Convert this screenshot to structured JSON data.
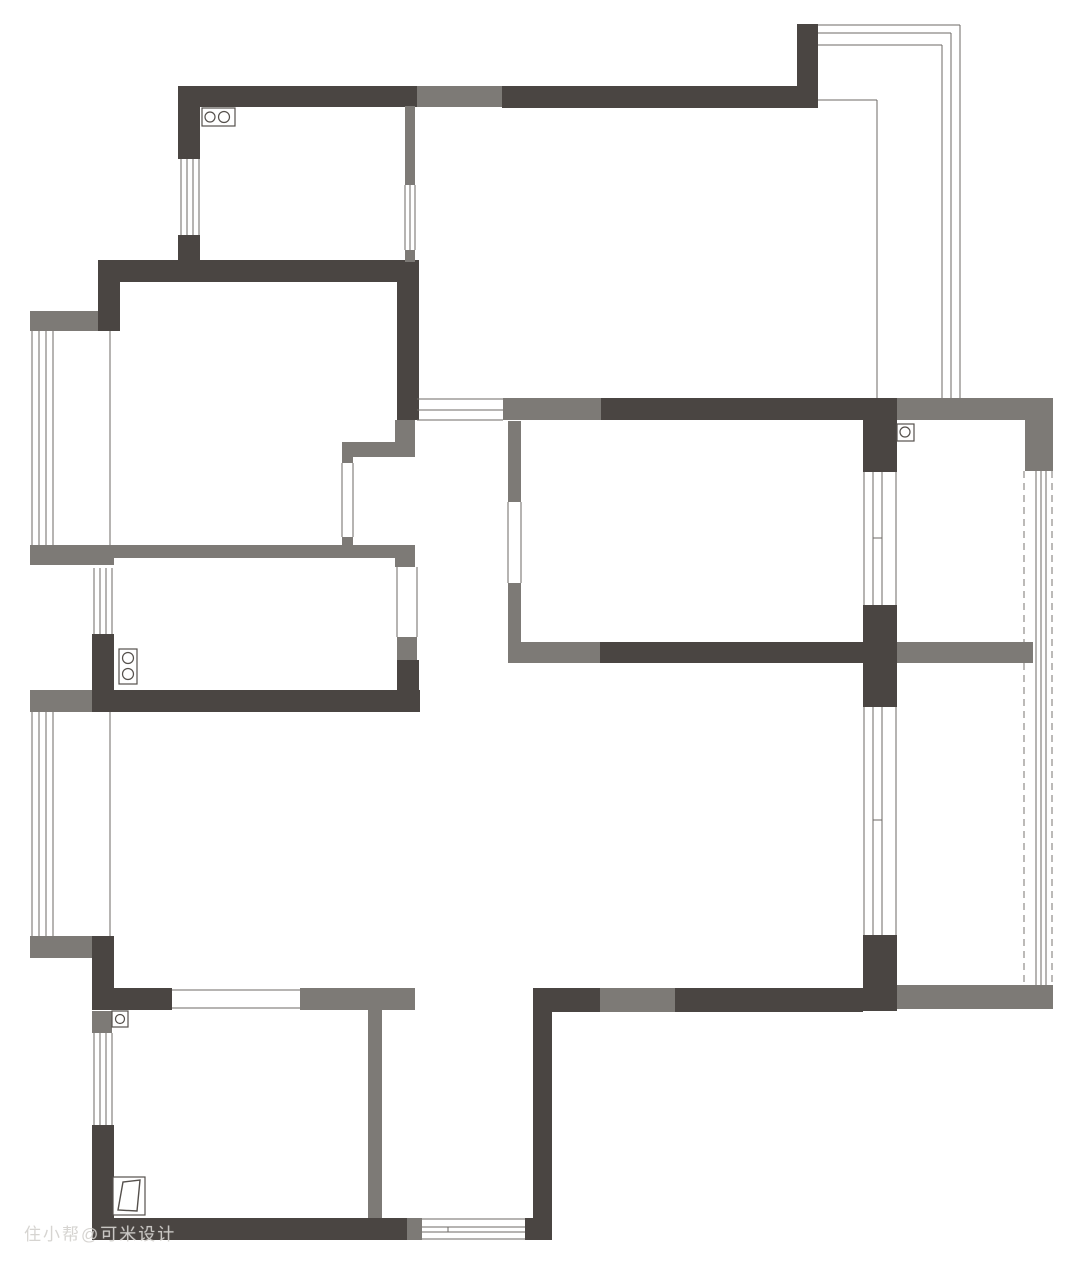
{
  "watermark": {
    "text": "住小帮@可米设计"
  },
  "plan": {
    "canvas": {
      "width": 1080,
      "height": 1270,
      "background": "#ffffff"
    },
    "colors": {
      "wall_dark": "#4a4542",
      "wall_gray": "#7d7a76",
      "line": "#6e6a66",
      "dash_line": "#787572",
      "fixture_stroke": "#55504c",
      "fixture_fill": "#ffffff"
    },
    "walls": [
      {
        "x": 178,
        "y": 86,
        "w": 239,
        "h": 21,
        "c": "d",
        "name": "kitchen-top-wall"
      },
      {
        "x": 417,
        "y": 86,
        "w": 85,
        "h": 21,
        "c": "g",
        "name": "top-wall-gray-segment"
      },
      {
        "x": 502,
        "y": 86,
        "w": 316,
        "h": 22,
        "c": "d",
        "name": "top-wall-right"
      },
      {
        "x": 797,
        "y": 24,
        "w": 21,
        "h": 62,
        "c": "d",
        "name": "balcony-stub"
      },
      {
        "x": 178,
        "y": 86,
        "w": 22,
        "h": 73,
        "c": "d",
        "name": "kitchen-left-wall-upper"
      },
      {
        "x": 178,
        "y": 235,
        "w": 22,
        "h": 27,
        "c": "d",
        "name": "kitchen-left-wall-lower"
      },
      {
        "x": 98,
        "y": 260,
        "w": 321,
        "h": 22,
        "c": "d",
        "name": "kitchen-bottom-wall"
      },
      {
        "x": 98,
        "y": 260,
        "w": 22,
        "h": 71,
        "c": "d",
        "name": "left-upper-corner-wall"
      },
      {
        "x": 397,
        "y": 262,
        "w": 22,
        "h": 158,
        "c": "d",
        "name": "kitchen-right-wall"
      },
      {
        "x": 405,
        "y": 106,
        "w": 10,
        "h": 79,
        "c": "g",
        "name": "kitchen-partition-upper"
      },
      {
        "x": 405,
        "y": 250,
        "w": 10,
        "h": 12,
        "c": "g",
        "name": "kitchen-partition-stub"
      },
      {
        "x": 395,
        "y": 420,
        "w": 20,
        "h": 37,
        "c": "g",
        "name": "corridor-wall-stub"
      },
      {
        "x": 342,
        "y": 442,
        "w": 73,
        "h": 15,
        "c": "g",
        "name": "shaft-top-wall"
      },
      {
        "x": 342,
        "y": 442,
        "w": 11,
        "h": 21,
        "c": "g",
        "name": "shaft-left-stub-top"
      },
      {
        "x": 342,
        "y": 537,
        "w": 11,
        "h": 21,
        "c": "g",
        "name": "shaft-left-stub-bottom"
      },
      {
        "x": 114,
        "y": 545,
        "w": 301,
        "h": 13,
        "c": "g",
        "name": "bath-top-wall"
      },
      {
        "x": 30,
        "y": 311,
        "w": 68,
        "h": 20,
        "c": "g",
        "name": "bay1-top-stub"
      },
      {
        "x": 30,
        "y": 545,
        "w": 84,
        "h": 20,
        "c": "g",
        "name": "bay1-bottom-stub"
      },
      {
        "x": 395,
        "y": 545,
        "w": 20,
        "h": 22,
        "c": "g",
        "name": "bath-door-jamb-top"
      },
      {
        "x": 397,
        "y": 637,
        "w": 20,
        "h": 23,
        "c": "g",
        "name": "bath-door-jamb-bottom"
      },
      {
        "x": 397,
        "y": 660,
        "w": 22,
        "h": 52,
        "c": "d",
        "name": "bath-right-wall-lower"
      },
      {
        "x": 92,
        "y": 634,
        "w": 22,
        "h": 58,
        "c": "d",
        "name": "bath-left-wall-lower"
      },
      {
        "x": 92,
        "y": 690,
        "w": 328,
        "h": 22,
        "c": "d",
        "name": "bath-bottom-wall"
      },
      {
        "x": 30,
        "y": 690,
        "w": 62,
        "h": 22,
        "c": "g",
        "name": "bay2-top-stub"
      },
      {
        "x": 30,
        "y": 936,
        "w": 62,
        "h": 22,
        "c": "g",
        "name": "bay2-bottom-stub"
      },
      {
        "x": 92,
        "y": 936,
        "w": 22,
        "h": 74,
        "c": "d",
        "name": "left-lower-corner-wall"
      },
      {
        "x": 114,
        "y": 988,
        "w": 58,
        "h": 22,
        "c": "d",
        "name": "bedroom1-top-wall-left"
      },
      {
        "x": 300,
        "y": 988,
        "w": 115,
        "h": 22,
        "c": "g",
        "name": "bedroom1-top-wall-right"
      },
      {
        "x": 92,
        "y": 1011,
        "w": 20,
        "h": 22,
        "c": "g",
        "name": "bedroom1-left-stub"
      },
      {
        "x": 92,
        "y": 1125,
        "w": 22,
        "h": 115,
        "c": "d",
        "name": "bedroom1-left-wall-lower"
      },
      {
        "x": 92,
        "y": 1218,
        "w": 315,
        "h": 22,
        "c": "d",
        "name": "bottom-wall-left"
      },
      {
        "x": 407,
        "y": 1218,
        "w": 15,
        "h": 22,
        "c": "g",
        "name": "bottom-window-jamb"
      },
      {
        "x": 525,
        "y": 1218,
        "w": 27,
        "h": 22,
        "c": "d",
        "name": "bottom-wall-right-end"
      },
      {
        "x": 368,
        "y": 1010,
        "w": 14,
        "h": 208,
        "c": "g",
        "name": "bedroom1-right-wall"
      },
      {
        "x": 533,
        "y": 988,
        "w": 19,
        "h": 252,
        "c": "d",
        "name": "bottom-room-right-wall"
      },
      {
        "x": 533,
        "y": 988,
        "w": 67,
        "h": 24,
        "c": "d",
        "name": "living-bottom-wall-1"
      },
      {
        "x": 600,
        "y": 988,
        "w": 75,
        "h": 24,
        "c": "g",
        "name": "living-bottom-wall-2"
      },
      {
        "x": 675,
        "y": 988,
        "w": 188,
        "h": 24,
        "c": "d",
        "name": "living-bottom-wall-3"
      },
      {
        "x": 895,
        "y": 985,
        "w": 158,
        "h": 24,
        "c": "g",
        "name": "living-bottom-wall-4"
      },
      {
        "x": 863,
        "y": 935,
        "w": 34,
        "h": 76,
        "c": "d",
        "name": "right-column-lower"
      },
      {
        "x": 863,
        "y": 605,
        "w": 34,
        "h": 102,
        "c": "d",
        "name": "right-column-middle"
      },
      {
        "x": 863,
        "y": 398,
        "w": 34,
        "h": 74,
        "c": "d",
        "name": "right-column-upper"
      },
      {
        "x": 503,
        "y": 398,
        "w": 98,
        "h": 22,
        "c": "g",
        "name": "dining-top-wall-gray"
      },
      {
        "x": 601,
        "y": 398,
        "w": 262,
        "h": 22,
        "c": "d",
        "name": "dining-top-wall-dark"
      },
      {
        "x": 897,
        "y": 398,
        "w": 128,
        "h": 22,
        "c": "g",
        "name": "bedroom2-top-wall"
      },
      {
        "x": 1025,
        "y": 398,
        "w": 28,
        "h": 73,
        "c": "g",
        "name": "bedroom2-right-corner"
      },
      {
        "x": 521,
        "y": 642,
        "w": 79,
        "h": 21,
        "c": "g",
        "name": "dining-bottom-wall-gray"
      },
      {
        "x": 600,
        "y": 642,
        "w": 263,
        "h": 21,
        "c": "d",
        "name": "dining-bottom-wall-dark"
      },
      {
        "x": 897,
        "y": 642,
        "w": 136,
        "h": 21,
        "c": "g",
        "name": "bedroom2-bottom-wall"
      },
      {
        "x": 508,
        "y": 421,
        "w": 13,
        "h": 81,
        "c": "g",
        "name": "dining-left-wall-upper"
      },
      {
        "x": 508,
        "y": 583,
        "w": 13,
        "h": 80,
        "c": "g",
        "name": "dining-left-wall-lower"
      }
    ],
    "lines": [
      {
        "o": "v",
        "x": 1024,
        "y": 471,
        "l": 514,
        "dash": true,
        "layer": "under",
        "name": "right-glass-dashed-1"
      },
      {
        "o": "v",
        "x": 1052,
        "y": 471,
        "l": 514,
        "dash": true,
        "layer": "under",
        "name": "right-glass-dashed-2"
      },
      {
        "o": "v",
        "x": 1036,
        "y": 471,
        "l": 514,
        "layer": "under",
        "name": "right-glass-line-1"
      },
      {
        "o": "v",
        "x": 1041,
        "y": 471,
        "l": 514,
        "layer": "under",
        "name": "right-glass-line-2"
      },
      {
        "o": "v",
        "x": 1046,
        "y": 471,
        "l": 514,
        "layer": "under",
        "name": "right-glass-line-3"
      },
      {
        "o": "h",
        "x": 818,
        "y": 25,
        "l": 142,
        "name": "balcony-edge-top-1"
      },
      {
        "o": "h",
        "x": 818,
        "y": 33,
        "l": 133,
        "name": "balcony-edge-top-2"
      },
      {
        "o": "h",
        "x": 818,
        "y": 45,
        "l": 124,
        "name": "balcony-edge-top-3"
      },
      {
        "o": "v",
        "x": 960,
        "y": 25,
        "l": 373,
        "name": "balcony-edge-right-1"
      },
      {
        "o": "v",
        "x": 951,
        "y": 33,
        "l": 365,
        "name": "balcony-edge-right-2"
      },
      {
        "o": "v",
        "x": 942,
        "y": 45,
        "l": 353,
        "name": "balcony-edge-right-3"
      },
      {
        "o": "h",
        "x": 818,
        "y": 100,
        "l": 59,
        "name": "balcony-inner-top"
      },
      {
        "o": "v",
        "x": 877,
        "y": 100,
        "l": 298,
        "name": "balcony-inner-right"
      },
      {
        "o": "v",
        "x": 181,
        "y": 159,
        "l": 76,
        "name": "kitchen-window-line"
      },
      {
        "o": "v",
        "x": 187,
        "y": 159,
        "l": 76,
        "name": "kitchen-window-line"
      },
      {
        "o": "v",
        "x": 193,
        "y": 159,
        "l": 76,
        "name": "kitchen-window-line"
      },
      {
        "o": "v",
        "x": 199,
        "y": 159,
        "l": 76,
        "name": "kitchen-window-line"
      },
      {
        "o": "v",
        "x": 32,
        "y": 331,
        "l": 214,
        "name": "bay1-window-line"
      },
      {
        "o": "v",
        "x": 39,
        "y": 331,
        "l": 214,
        "name": "bay1-window-line"
      },
      {
        "o": "v",
        "x": 46,
        "y": 331,
        "l": 214,
        "name": "bay1-window-line"
      },
      {
        "o": "v",
        "x": 53,
        "y": 331,
        "l": 214,
        "name": "bay1-window-line"
      },
      {
        "o": "v",
        "x": 110,
        "y": 331,
        "l": 214,
        "name": "bay1-inner-line"
      },
      {
        "o": "v",
        "x": 94,
        "y": 568,
        "l": 66,
        "name": "bath-window-line"
      },
      {
        "o": "v",
        "x": 100,
        "y": 568,
        "l": 66,
        "name": "bath-window-line"
      },
      {
        "o": "v",
        "x": 106,
        "y": 568,
        "l": 66,
        "name": "bath-window-line"
      },
      {
        "o": "v",
        "x": 112,
        "y": 568,
        "l": 66,
        "name": "bath-window-line"
      },
      {
        "o": "v",
        "x": 32,
        "y": 712,
        "l": 224,
        "name": "bay2-window-line"
      },
      {
        "o": "v",
        "x": 39,
        "y": 712,
        "l": 224,
        "name": "bay2-window-line"
      },
      {
        "o": "v",
        "x": 46,
        "y": 712,
        "l": 224,
        "name": "bay2-window-line"
      },
      {
        "o": "v",
        "x": 53,
        "y": 712,
        "l": 224,
        "name": "bay2-window-line"
      },
      {
        "o": "v",
        "x": 110,
        "y": 712,
        "l": 224,
        "name": "bay2-inner-line"
      },
      {
        "o": "v",
        "x": 94,
        "y": 1033,
        "l": 92,
        "name": "bedroom1-window-line"
      },
      {
        "o": "v",
        "x": 100,
        "y": 1033,
        "l": 92,
        "name": "bedroom1-window-line"
      },
      {
        "o": "v",
        "x": 106,
        "y": 1033,
        "l": 92,
        "name": "bedroom1-window-line"
      },
      {
        "o": "v",
        "x": 112,
        "y": 1033,
        "l": 92,
        "name": "bedroom1-window-line"
      },
      {
        "o": "h",
        "x": 422,
        "y": 1219,
        "l": 103,
        "name": "bottom-window-line"
      },
      {
        "o": "h",
        "x": 422,
        "y": 1227,
        "l": 103,
        "name": "bottom-window-line"
      },
      {
        "o": "h",
        "x": 422,
        "y": 1232,
        "l": 103,
        "name": "bottom-window-line"
      },
      {
        "o": "h",
        "x": 422,
        "y": 1239,
        "l": 103,
        "name": "bottom-window-line"
      },
      {
        "o": "v",
        "x": 448,
        "y": 1227,
        "l": 5,
        "name": "bottom-window-tick"
      },
      {
        "o": "h",
        "x": 417,
        "y": 399,
        "l": 86,
        "name": "corridor-top-window-line"
      },
      {
        "o": "h",
        "x": 417,
        "y": 410,
        "l": 86,
        "name": "corridor-top-window-line"
      },
      {
        "o": "h",
        "x": 417,
        "y": 420,
        "l": 86,
        "name": "corridor-top-window-line"
      },
      {
        "o": "v",
        "x": 405,
        "y": 185,
        "l": 65,
        "name": "kitchen-partition-window-line"
      },
      {
        "o": "v",
        "x": 410,
        "y": 185,
        "l": 65,
        "name": "kitchen-partition-window-line"
      },
      {
        "o": "v",
        "x": 415,
        "y": 185,
        "l": 65,
        "name": "kitchen-partition-window-line"
      },
      {
        "o": "v",
        "x": 342,
        "y": 463,
        "l": 74,
        "name": "shaft-glass-line"
      },
      {
        "o": "v",
        "x": 353,
        "y": 463,
        "l": 74,
        "name": "shaft-glass-line"
      },
      {
        "o": "v",
        "x": 397,
        "y": 567,
        "l": 70,
        "name": "bath-door-opening-line"
      },
      {
        "o": "v",
        "x": 417,
        "y": 567,
        "l": 70,
        "name": "bath-door-opening-line"
      },
      {
        "o": "v",
        "x": 508,
        "y": 502,
        "l": 81,
        "name": "dining-opening-line"
      },
      {
        "o": "v",
        "x": 521,
        "y": 502,
        "l": 81,
        "name": "dining-opening-line"
      },
      {
        "o": "v",
        "x": 864,
        "y": 472,
        "l": 133,
        "name": "dining-window-line"
      },
      {
        "o": "v",
        "x": 873,
        "y": 472,
        "l": 133,
        "name": "dining-window-line"
      },
      {
        "o": "v",
        "x": 882,
        "y": 472,
        "l": 133,
        "name": "dining-window-line"
      },
      {
        "o": "v",
        "x": 896,
        "y": 472,
        "l": 133,
        "name": "dining-window-line"
      },
      {
        "o": "h",
        "x": 873,
        "y": 538,
        "l": 9,
        "name": "dining-window-tick"
      },
      {
        "o": "v",
        "x": 864,
        "y": 707,
        "l": 228,
        "name": "living-right-window-line"
      },
      {
        "o": "v",
        "x": 873,
        "y": 707,
        "l": 228,
        "name": "living-right-window-line"
      },
      {
        "o": "v",
        "x": 882,
        "y": 707,
        "l": 228,
        "name": "living-right-window-line"
      },
      {
        "o": "v",
        "x": 896,
        "y": 707,
        "l": 228,
        "name": "living-right-window-line"
      },
      {
        "o": "h",
        "x": 873,
        "y": 820,
        "l": 9,
        "name": "living-right-window-tick"
      },
      {
        "o": "h",
        "x": 172,
        "y": 990,
        "l": 128,
        "name": "bedroom1-opening-line"
      },
      {
        "o": "h",
        "x": 172,
        "y": 1008,
        "l": 128,
        "name": "bedroom1-opening-line"
      }
    ],
    "boxes": [
      {
        "x": 202,
        "y": 108,
        "w": 33,
        "h": 18,
        "name": "stove-icon"
      },
      {
        "x": 897,
        "y": 424,
        "w": 17,
        "h": 17,
        "name": "water-heater-icon"
      },
      {
        "x": 119,
        "y": 649,
        "w": 18,
        "h": 35,
        "name": "washer-icon"
      },
      {
        "x": 112,
        "y": 1011,
        "w": 16,
        "h": 16,
        "name": "floor-drain-icon"
      },
      {
        "x": 113,
        "y": 1177,
        "w": 32,
        "h": 38,
        "name": "door-icon-frame"
      }
    ],
    "circles": [
      {
        "cx": 210,
        "cy": 117,
        "r": 5,
        "name": "stove-burner-1"
      },
      {
        "cx": 224,
        "cy": 117,
        "r": 5.5,
        "name": "stove-burner-2"
      },
      {
        "cx": 905,
        "cy": 432,
        "r": 5,
        "name": "water-heater-circle"
      },
      {
        "cx": 128,
        "cy": 658,
        "r": 5.5,
        "name": "washer-circle-1"
      },
      {
        "cx": 128,
        "cy": 674,
        "r": 5.5,
        "name": "washer-circle-2"
      },
      {
        "cx": 120,
        "cy": 1019,
        "r": 4.5,
        "name": "floor-drain-circle"
      }
    ],
    "door_leaf": {
      "points": "118,1210 123,1182 140,1180 137,1211",
      "name": "door-leaf"
    }
  }
}
